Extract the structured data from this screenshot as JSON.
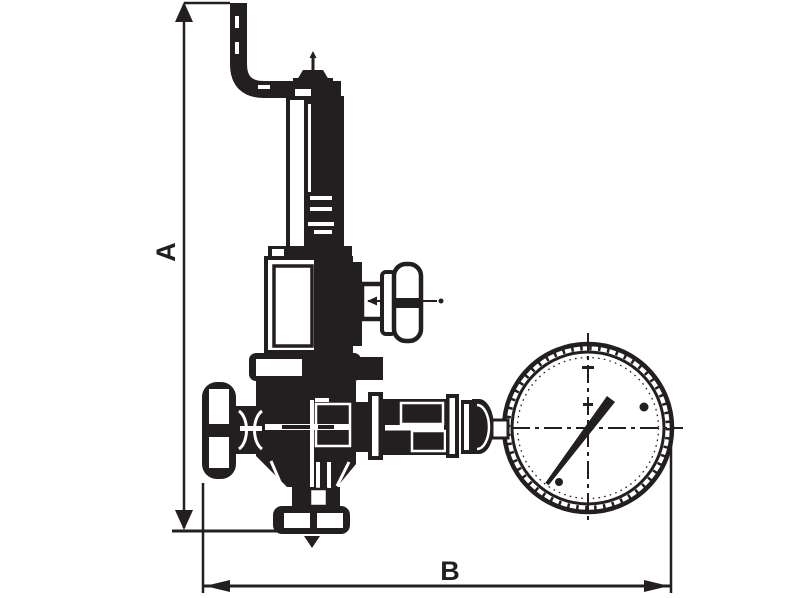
{
  "diagram": {
    "type": "technical-line-drawing",
    "subject": "spring safety valve with handwheel and pressure gauge",
    "dimension_labels": {
      "vertical": "A",
      "horizontal": "B"
    }
  },
  "colors": {
    "ink": "#231f20",
    "background": "#ffffff"
  },
  "icons": [
    "dimension-arrow-icon",
    "exhaust-elbow-pipe-icon",
    "spring-housing-icon",
    "test-lever-handle-icon",
    "handwheel-icon",
    "outlet-flange-icon",
    "union-fitting-icon",
    "pressure-gauge-icon",
    "gauge-needle-icon"
  ]
}
